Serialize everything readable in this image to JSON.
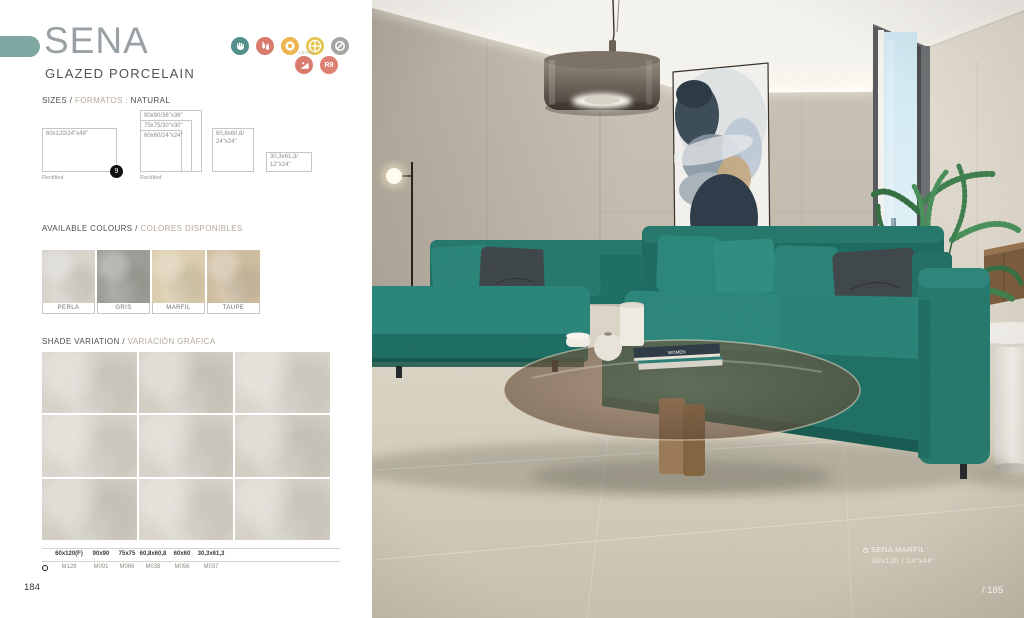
{
  "accent_color": "#7fa8a2",
  "header": {
    "title": "SENA",
    "subtitle": "GLAZED PORCELAIN",
    "icons": [
      {
        "name": "hand-certification",
        "color": "#53908c"
      },
      {
        "name": "footprints-traffic",
        "color": "#d97b6c"
      },
      {
        "name": "ring",
        "color": "#edb54f"
      },
      {
        "name": "cross-circle",
        "color": "#e3c44d"
      },
      {
        "name": "no-sign",
        "color": "#a7a5a1"
      },
      {
        "name": "slip-ramp",
        "color": "#d97b6c",
        "label": "LEVEL"
      },
      {
        "name": "slip-rating",
        "color": "#dd8273",
        "label": "R9"
      }
    ]
  },
  "sizes": {
    "heading": {
      "primary": "SIZES /",
      "secondary": "FORMATOS :",
      "suffix": "NATURAL"
    },
    "boxes": [
      "60x120/24\"x48\"",
      "90x90/36\"x36\"",
      "75x75/30\"x30\"",
      "60x60/24\"x24\"",
      "60,8x60,8/\n24\"x24\"",
      "30,3x61,3/\n12\"x24\""
    ],
    "rectified": "Rectified",
    "thickness_badge": "9"
  },
  "colours": {
    "heading": {
      "primary": "AVAILABLE COLOURS /",
      "secondary": "COLORES DISPONIBLES"
    },
    "swatches": [
      {
        "label": "PERLA",
        "color": "#d7d4cc"
      },
      {
        "label": "GRIS",
        "color": "#9c9d97"
      },
      {
        "label": "MARFIL",
        "color": "#dbcdad"
      },
      {
        "label": "TAUPE",
        "color": "#cfbda0"
      }
    ]
  },
  "shade": {
    "heading": {
      "primary": "SHADE VARIATION /",
      "secondary": "VARIACIÓN GRÁFICA"
    }
  },
  "table": {
    "columns": [
      {
        "size": "60x120(F)",
        "code": "M128"
      },
      {
        "size": "90x90",
        "code": "M091"
      },
      {
        "size": "75x75",
        "code": "M066"
      },
      {
        "size": "60,8x60,8",
        "code": "M038"
      },
      {
        "size": "60x60",
        "code": "M056"
      },
      {
        "size": "30,3x61,3",
        "code": "M037"
      }
    ]
  },
  "photo": {
    "caption": {
      "name": "SENA MARFIL",
      "size": "60x120  /  24\"x48\""
    },
    "book_title": "WOMEN"
  },
  "page": {
    "left": "184",
    "right": "/ 185"
  }
}
